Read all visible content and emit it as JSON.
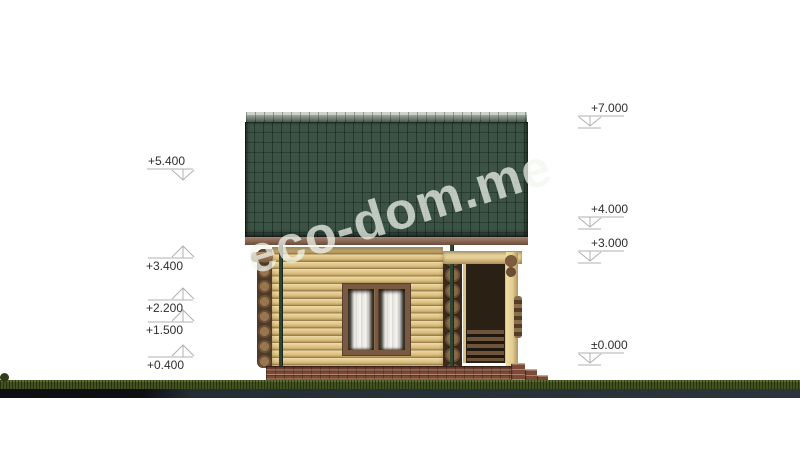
{
  "watermark": {
    "text": "eco-dom.me"
  },
  "drawing": {
    "type": "architectural-elevation",
    "subject": "single-storey log house with green tiled roof, window with curtains, open porch with steps, brick foundation on grass strip",
    "elevation_values_m": [
      7.0,
      5.4,
      4.0,
      3.4,
      3.0,
      2.2,
      1.5,
      0.4,
      0.0
    ]
  },
  "palette": {
    "roof_green": "#3b5244",
    "ridge_cap": "#66786a",
    "fascia_brown": "#8d6a56",
    "wall_tan": "#ddc285",
    "window_frame": "#7a5941",
    "window_dark": "#2e271d",
    "porch_beam": "#e3cd92",
    "porch_dark": "#2a2014",
    "brick": "#7c4a38",
    "grass": "#44521f",
    "pipe_green": "#2c4733",
    "watermark": "rgba(243,246,238,0.72)",
    "marker_line": "#b0b0b0",
    "marker_text": "#2e2e2e"
  },
  "markers": {
    "items": [
      {
        "label": "+5.400",
        "value": 5.4,
        "side": "left",
        "x1": 147,
        "x2": 193,
        "y": 169,
        "ax": 183,
        "tip": 180,
        "dir": "down",
        "base": false,
        "label_x": 185,
        "label_y": 165,
        "anchor": "end"
      },
      {
        "label": "+3.400",
        "value": 3.4,
        "side": "left",
        "x1": 148,
        "x2": 193,
        "y": 258,
        "ax": 183,
        "tip": 246,
        "dir": "up",
        "base": false,
        "label_x": 183,
        "label_y": 270,
        "anchor": "end"
      },
      {
        "label": "+2.200",
        "value": 2.2,
        "side": "left",
        "x1": 148,
        "x2": 193,
        "y": 300,
        "ax": 183,
        "tip": 288,
        "dir": "up",
        "base": false,
        "label_x": 183,
        "label_y": 312,
        "anchor": "end"
      },
      {
        "label": "+1.500",
        "value": 1.5,
        "side": "left",
        "x1": 148,
        "x2": 193,
        "y": 322,
        "ax": 183,
        "tip": 310,
        "dir": "up",
        "base": false,
        "label_x": 183,
        "label_y": 334,
        "anchor": "end"
      },
      {
        "label": "+0.400",
        "value": 0.4,
        "side": "left",
        "x1": 148,
        "x2": 193,
        "y": 357,
        "ax": 183,
        "tip": 345,
        "dir": "up",
        "base": false,
        "label_x": 184,
        "label_y": 369,
        "anchor": "end"
      },
      {
        "label": "+7.000",
        "value": 7.0,
        "side": "right",
        "x1": 578,
        "x2": 624,
        "y": 116,
        "ax": 590,
        "tip": 126,
        "dir": "down",
        "base": true,
        "label_x": 591,
        "label_y": 112,
        "anchor": "start"
      },
      {
        "label": "+4.000",
        "value": 4.0,
        "side": "right",
        "x1": 578,
        "x2": 624,
        "y": 217,
        "ax": 590,
        "tip": 227,
        "dir": "down",
        "base": true,
        "label_x": 591,
        "label_y": 213,
        "anchor": "start"
      },
      {
        "label": "+3.000",
        "value": 3.0,
        "side": "right",
        "x1": 578,
        "x2": 624,
        "y": 251,
        "ax": 590,
        "tip": 261,
        "dir": "down",
        "base": true,
        "label_x": 591,
        "label_y": 247,
        "anchor": "start"
      },
      {
        "label": "±0.000",
        "value": 0.0,
        "side": "right",
        "x1": 578,
        "x2": 624,
        "y": 353,
        "ax": 590,
        "tip": 363,
        "dir": "down",
        "base": true,
        "label_x": 591,
        "label_y": 349,
        "anchor": "start"
      }
    ]
  }
}
